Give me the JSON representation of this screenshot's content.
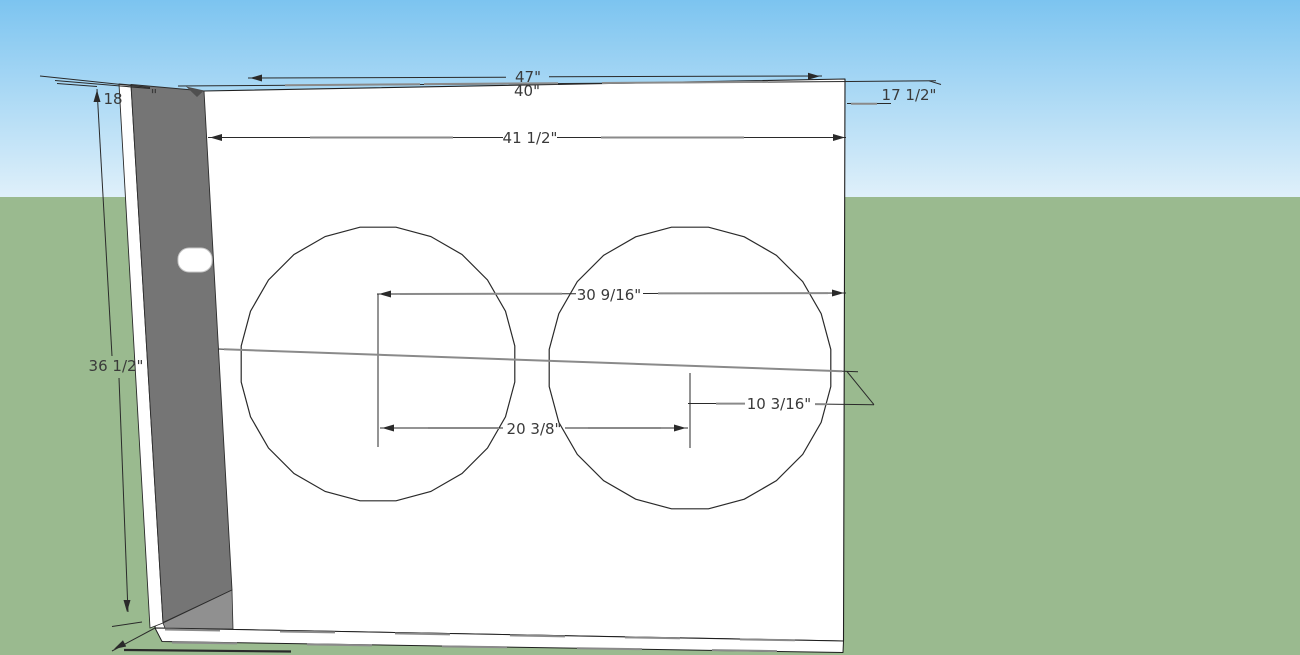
{
  "scene": {
    "description": "SketchUp-style 3D viewport showing a white speaker cabinet baffle with two circular speaker cutouts and dimension annotations",
    "colors": {
      "sky_top": "#7CC4F0",
      "sky_bottom": "#DFF0FA",
      "ground": "#9ABA8F",
      "panel_fill": "#FFFFFF",
      "side_panel_fill": "#757575",
      "side_panel_shade": "#4F4F4F",
      "bottom_face_fill": "#909090",
      "edge_color": "#1F1F1F",
      "profile_gray": "#8A8A8A",
      "dim_text_color": "#3A3A3A",
      "peg_stroke": "#C8C8C8"
    },
    "horizon_y": 197,
    "text_size": 15
  },
  "model": {
    "polygons": [
      {
        "id": "front-panel",
        "points": [
          [
            204,
            91
          ],
          [
            845,
            79
          ],
          [
            843.5,
            641
          ],
          [
            155,
            628
          ]
        ],
        "fill": "#FFFFFF",
        "stroke": "#1F1F1F",
        "w": 1.1
      },
      {
        "id": "bottom-panel-edge",
        "points": [
          [
            155,
            628
          ],
          [
            843.5,
            641
          ],
          [
            843,
            652.5
          ],
          [
            162,
            641.5
          ]
        ],
        "fill": "#FFFFFF",
        "stroke": "#1F1F1F",
        "w": 1
      },
      {
        "id": "left-panel-outer-edge",
        "points": [
          [
            119,
            84
          ],
          [
            131,
            85
          ],
          [
            163,
            623
          ],
          [
            150,
            628
          ]
        ],
        "fill": "#FFFFFF",
        "stroke": "#2A2A2A",
        "w": 0.9
      },
      {
        "id": "left-panel-inner-face",
        "points": [
          [
            131,
            84.5
          ],
          [
            204,
            91
          ],
          [
            232,
            590
          ],
          [
            163,
            622.5
          ]
        ],
        "fill": "#757575",
        "stroke": "#2C2C2C",
        "w": 0.9
      },
      {
        "id": "left-panel-corner-shade",
        "points": [
          [
            186,
            86.5
          ],
          [
            204,
            90.5
          ],
          [
            197,
            97
          ]
        ],
        "fill": "#4F4F4F",
        "stroke": "none",
        "w": 0
      },
      {
        "id": "bottom-inner-face",
        "points": [
          [
            163,
            623
          ],
          [
            232,
            590
          ],
          [
            233,
            629
          ],
          [
            165,
            628
          ]
        ],
        "fill": "#909090",
        "stroke": "#2C2C2C",
        "w": 0.8
      }
    ],
    "dash_overlays": [
      {
        "id": "bottom-edge-profile-1",
        "x1": 165,
        "y1": 629.5,
        "x2": 838,
        "y2": 641,
        "dash": "55 60",
        "color": "#8A8A8A",
        "w": 2
      },
      {
        "id": "bottom-edge-profile-2",
        "x1": 172,
        "y1": 642.5,
        "x2": 840,
        "y2": 652,
        "dash": "65 70",
        "color": "#8A8A8A",
        "w": 2
      }
    ],
    "peg": {
      "id": "port-peg",
      "x": 178,
      "y": 248,
      "w": 34,
      "h": 24,
      "rx": 11
    },
    "circles": [
      {
        "id": "speaker-cutout-left",
        "cx": 378,
        "cy": 364,
        "r": 138,
        "sides": 24
      },
      {
        "id": "speaker-cutout-right",
        "cx": 690,
        "cy": 368,
        "r": 142,
        "sides": 24
      }
    ]
  },
  "annotations": [
    {
      "id": "dim-47",
      "label": "47\"",
      "value_in": 47,
      "text": {
        "x": 528,
        "y": 82,
        "anchor": "middle"
      },
      "lines": [
        [
          248,
          78,
          506,
          77.3
        ],
        [
          549,
          76.8,
          822,
          76
        ]
      ],
      "grays": [],
      "arrows": [
        [
          250,
          78,
          180
        ],
        [
          820,
          76.2,
          0
        ]
      ]
    },
    {
      "id": "dim-40",
      "label": "40\"",
      "value_in": 40,
      "text": {
        "x": 527,
        "y": 96,
        "anchor": "middle"
      },
      "lines": [
        [
          178,
          86,
          508,
          84
        ],
        [
          546,
          83.6,
          850,
          81.5
        ],
        [
          850,
          81.5,
          936,
          80.8
        ],
        [
          929,
          80.8,
          941,
          84.5
        ]
      ],
      "grays": [
        [
          285,
          85.2,
          420,
          84.2
        ],
        [
          424,
          84.1,
          558,
          83.2
        ],
        [
          602,
          83,
          768,
          81.9
        ]
      ],
      "arrows": []
    },
    {
      "id": "dim-17-1-2",
      "label": "17 1/2\"",
      "value_in": 17.5,
      "text": {
        "x": 909,
        "y": 100,
        "anchor": "middle"
      },
      "lines": [
        [
          847,
          103.5,
          891,
          103.5
        ]
      ],
      "grays": [
        [
          851,
          103.8,
          877,
          103.8
        ]
      ],
      "arrows": []
    },
    {
      "id": "dim-41-1-2",
      "label": "41 1/2\"",
      "value_in": 41.5,
      "text": {
        "x": 530,
        "y": 143,
        "anchor": "middle"
      },
      "lines": [
        [
          208,
          137.5,
          503,
          137.5
        ],
        [
          557,
          137.5,
          846,
          137.5
        ]
      ],
      "grays": [
        [
          310,
          137.5,
          453,
          137.5
        ],
        [
          601,
          137.5,
          744,
          137.5
        ]
      ],
      "arrows": [
        [
          210,
          137.5,
          180
        ],
        [
          845,
          137.5,
          0
        ]
      ]
    },
    {
      "id": "dim-36-1-2",
      "label": "36 1/2\"",
      "value_in": 36.5,
      "text": {
        "x": 116,
        "y": 371,
        "anchor": "middle"
      },
      "lines": [
        [
          97,
          89,
          112,
          356
        ],
        [
          119,
          378,
          128,
          612
        ],
        [
          55,
          80.5,
          150,
          88.5
        ],
        [
          112,
          626.5,
          142,
          622
        ],
        [
          155,
          628,
          112,
          651
        ]
      ],
      "wide_lines": [
        [
          124,
          650,
          291,
          651.5
        ]
      ],
      "grays": [],
      "arrows": [
        [
          97,
          90,
          270
        ],
        [
          127,
          612,
          90
        ],
        [
          114,
          649,
          152
        ]
      ]
    },
    {
      "id": "dim-18",
      "label": "18",
      "value_in": 18,
      "text": {
        "x": 113,
        "y": 104,
        "anchor": "middle"
      },
      "extra_texts": [
        {
          "str": "\"",
          "x": 154,
          "y": 100,
          "anchor": "middle"
        }
      ],
      "lines": [
        [
          40,
          76,
          150,
          87.5
        ],
        [
          57,
          83.5,
          97,
          86.5
        ]
      ],
      "grays": [],
      "arrows": []
    },
    {
      "id": "dim-30-9-16",
      "label": "30 9/16\"",
      "value_in": 30.5625,
      "text": {
        "x": 609,
        "y": 300,
        "anchor": "middle"
      },
      "lines": [
        [
          377,
          294,
          576,
          293.8
        ],
        [
          643,
          293.5,
          846,
          293
        ],
        [
          378,
          294,
          378,
          447
        ]
      ],
      "grays": [
        [
          400,
          294,
          562,
          293.7
        ],
        [
          658,
          293.4,
          828,
          293.1
        ]
      ],
      "arrows": [
        [
          379,
          294,
          180
        ],
        [
          844,
          293,
          0
        ]
      ]
    },
    {
      "id": "dim-20-3-8",
      "label": "20 3/8\"",
      "value_in": 20.375,
      "text": {
        "x": 534,
        "y": 434,
        "anchor": "middle"
      },
      "lines": [
        [
          380,
          428,
          503,
          428
        ],
        [
          565,
          428,
          688,
          428
        ],
        [
          690,
          373,
          690,
          448
        ]
      ],
      "grays": [
        [
          428,
          428,
          499,
          428
        ],
        [
          588,
          428,
          661,
          428
        ]
      ],
      "arrows": [
        [
          382,
          428,
          180
        ],
        [
          686,
          428,
          0
        ]
      ]
    },
    {
      "id": "dim-10-3-16",
      "label": "10 3/16\"",
      "value_in": 10.1875,
      "text": {
        "x": 779,
        "y": 409,
        "anchor": "middle"
      },
      "lines": [
        [
          688,
          403.5,
          744,
          403.5
        ],
        [
          815,
          404,
          874,
          404.7
        ],
        [
          847,
          371.5,
          874,
          404.7
        ]
      ],
      "grays": [
        [
          716,
          403.6,
          745,
          403.6
        ],
        [
          815,
          404.1,
          827,
          404.2
        ]
      ],
      "arrows": []
    },
    {
      "id": "speaker-centerline",
      "label": "",
      "text": null,
      "lines": [
        [
          218,
          349,
          858,
          371.8
        ]
      ],
      "grays": [
        [
          224,
          349.3,
          842,
          371.2
        ]
      ],
      "arrows": []
    }
  ]
}
